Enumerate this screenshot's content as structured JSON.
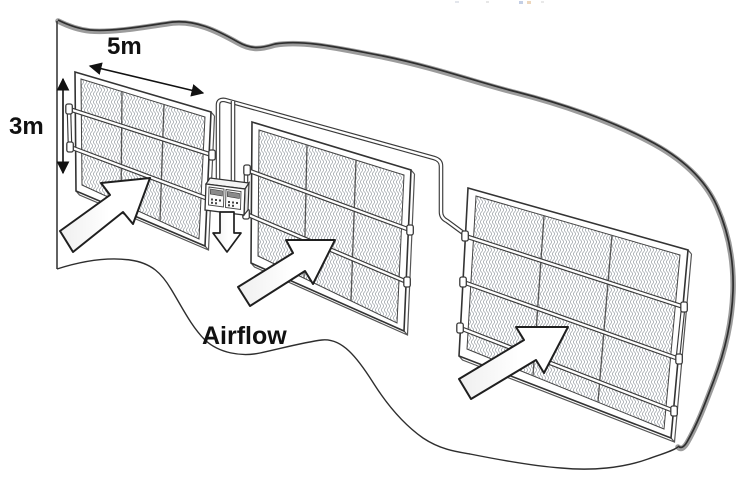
{
  "diagram": {
    "labels": {
      "panel_width": "5m",
      "panel_height": "3m",
      "airflow": "Airflow"
    },
    "colors": {
      "ink": "#111111",
      "line": "#2e2e2e",
      "ribbon": "#9c9c9c",
      "mesh": "#9aa0a6",
      "frame": "#3a3a3a",
      "arrow_fill": "#ffffff"
    },
    "panels": [
      {
        "name": "mesh-panel-1",
        "mesh_columns": 3,
        "mesh_rows": 3,
        "pipe_rails": 2
      },
      {
        "name": "mesh-panel-2",
        "mesh_columns": 3,
        "mesh_rows": 3,
        "pipe_rails": 2
      },
      {
        "name": "mesh-panel-3",
        "mesh_columns": 3,
        "mesh_rows": 4,
        "pipe_rails": 3
      }
    ],
    "icons": {
      "airflow_arrow_count": 3,
      "down_arrow_count": 1,
      "width_dimension": "double-headed-arrow",
      "height_dimension": "double-headed-arrow"
    }
  }
}
